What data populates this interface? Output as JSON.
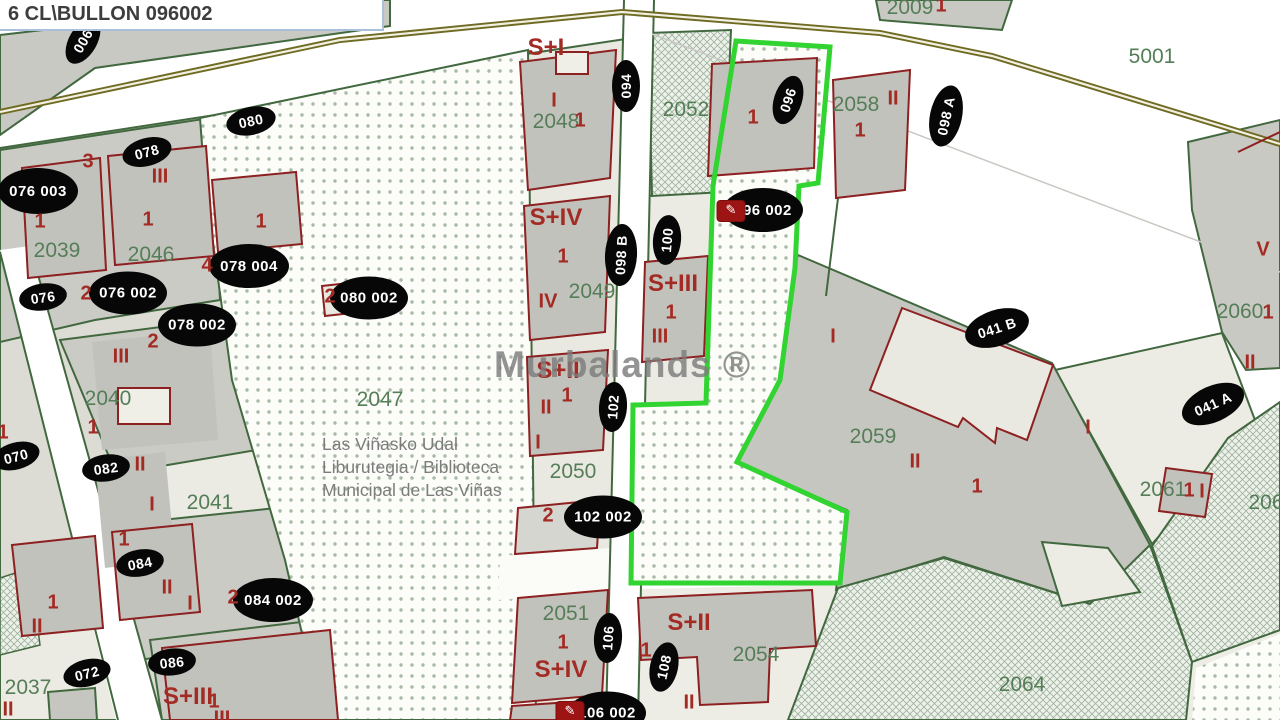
{
  "header": {
    "title": "6 CL\\BULLON 096002"
  },
  "watermark": "Murbalands ®",
  "library_poi": {
    "lines": [
      "Las Viñasko Udal",
      "Liburutegia / Biblioteca",
      "Municipal de Las Viñas"
    ]
  },
  "colors": {
    "selection_green": "#31d431",
    "boundary_green": "#42683f",
    "building_red": "#8d2020",
    "label_green": "#557e58",
    "label_red": "#a32b24",
    "road_olive": "#6f6b22",
    "oval_black": "#070707"
  },
  "icons": {
    "edit_glyph": "✎"
  },
  "map": {
    "ovals": [
      {
        "t": "006",
        "x": 83,
        "y": 41,
        "r": -60,
        "w": 50,
        "h": 28
      },
      {
        "t": "094",
        "x": 626,
        "y": 86,
        "r": -90,
        "w": 52,
        "h": 28
      },
      {
        "t": "096",
        "x": 788,
        "y": 100,
        "r": -72,
        "w": 50,
        "h": 28
      },
      {
        "t": "098 A",
        "x": 946,
        "y": 116,
        "r": -78,
        "w": 62,
        "h": 32
      },
      {
        "t": "076 003",
        "x": 38,
        "y": 191,
        "r": 0,
        "w": 80,
        "h": 46
      },
      {
        "t": "078",
        "x": 147,
        "y": 152,
        "r": -15,
        "w": 50,
        "h": 28
      },
      {
        "t": "080",
        "x": 251,
        "y": 121,
        "r": -12,
        "w": 50,
        "h": 28
      },
      {
        "t": "096 002",
        "x": 763,
        "y": 210,
        "r": 0,
        "w": 80,
        "h": 44
      },
      {
        "t": "098 B",
        "x": 621,
        "y": 255,
        "r": -87,
        "w": 62,
        "h": 32
      },
      {
        "t": "100",
        "x": 667,
        "y": 240,
        "r": -85,
        "w": 50,
        "h": 28
      },
      {
        "t": "078 004",
        "x": 249,
        "y": 266,
        "r": 0,
        "w": 80,
        "h": 44
      },
      {
        "t": "076",
        "x": 43,
        "y": 297,
        "r": -8,
        "w": 48,
        "h": 27
      },
      {
        "t": "076 002",
        "x": 128,
        "y": 293,
        "r": 0,
        "w": 78,
        "h": 43
      },
      {
        "t": "080 002",
        "x": 369,
        "y": 298,
        "r": 0,
        "w": 78,
        "h": 43
      },
      {
        "t": "078 002",
        "x": 197,
        "y": 325,
        "r": 0,
        "w": 78,
        "h": 43
      },
      {
        "t": "041 B",
        "x": 997,
        "y": 328,
        "r": -18,
        "w": 66,
        "h": 36
      },
      {
        "t": "041 A",
        "x": 1213,
        "y": 404,
        "r": -24,
        "w": 66,
        "h": 36
      },
      {
        "t": "102",
        "x": 613,
        "y": 407,
        "r": -86,
        "w": 50,
        "h": 28
      },
      {
        "t": "070",
        "x": 16,
        "y": 456,
        "r": -15,
        "w": 48,
        "h": 27
      },
      {
        "t": "082",
        "x": 106,
        "y": 468,
        "r": -8,
        "w": 48,
        "h": 27
      },
      {
        "t": "102 002",
        "x": 603,
        "y": 517,
        "r": 0,
        "w": 78,
        "h": 43
      },
      {
        "t": "084",
        "x": 140,
        "y": 563,
        "r": -10,
        "w": 48,
        "h": 27
      },
      {
        "t": "084 002",
        "x": 273,
        "y": 600,
        "r": 0,
        "w": 80,
        "h": 44
      },
      {
        "t": "106",
        "x": 608,
        "y": 638,
        "r": -86,
        "w": 50,
        "h": 28
      },
      {
        "t": "086",
        "x": 172,
        "y": 662,
        "r": -6,
        "w": 48,
        "h": 27
      },
      {
        "t": "108",
        "x": 664,
        "y": 667,
        "r": -78,
        "w": 50,
        "h": 28
      },
      {
        "t": "072",
        "x": 87,
        "y": 673,
        "r": -14,
        "w": 48,
        "h": 27
      },
      {
        "t": "106 002",
        "x": 607,
        "y": 713,
        "r": 0,
        "w": 78,
        "h": 43
      }
    ],
    "green_labels": [
      {
        "t": "2009",
        "x": 910,
        "y": 8
      },
      {
        "t": "5001",
        "x": 1152,
        "y": 57
      },
      {
        "t": "2052",
        "x": 686,
        "y": 110
      },
      {
        "t": "2058",
        "x": 856,
        "y": 105
      },
      {
        "t": "2048",
        "x": 556,
        "y": 122
      },
      {
        "t": "2039",
        "x": 57,
        "y": 251
      },
      {
        "t": "2046",
        "x": 151,
        "y": 255
      },
      {
        "t": "2049",
        "x": 592,
        "y": 292
      },
      {
        "t": "2060",
        "x": 1240,
        "y": 312
      },
      {
        "t": "2047",
        "x": 380,
        "y": 400
      },
      {
        "t": "2040",
        "x": 108,
        "y": 399
      },
      {
        "t": "2059",
        "x": 873,
        "y": 437
      },
      {
        "t": "2050",
        "x": 573,
        "y": 472
      },
      {
        "t": "2061",
        "x": 1163,
        "y": 490
      },
      {
        "t": "206",
        "x": 1266,
        "y": 503
      },
      {
        "t": "2041",
        "x": 210,
        "y": 503
      },
      {
        "t": "2051",
        "x": 566,
        "y": 614
      },
      {
        "t": "2054",
        "x": 756,
        "y": 655
      },
      {
        "t": "2064",
        "x": 1022,
        "y": 685
      },
      {
        "t": "2037",
        "x": 28,
        "y": 688
      }
    ],
    "red_labels": [
      {
        "t": "S+I",
        "x": 546,
        "y": 48,
        "s": 24
      },
      {
        "t": "1",
        "x": 941,
        "y": 6
      },
      {
        "t": "I",
        "x": 554,
        "y": 101
      },
      {
        "t": "II",
        "x": 893,
        "y": 99
      },
      {
        "t": "1",
        "x": 580,
        "y": 121
      },
      {
        "t": "1",
        "x": 753,
        "y": 118
      },
      {
        "t": "1",
        "x": 860,
        "y": 131
      },
      {
        "t": "3",
        "x": 88,
        "y": 162
      },
      {
        "t": "III",
        "x": 160,
        "y": 177
      },
      {
        "t": "S+IV",
        "x": 556,
        "y": 218,
        "s": 24
      },
      {
        "t": "1",
        "x": 40,
        "y": 222
      },
      {
        "t": "1",
        "x": 148,
        "y": 220
      },
      {
        "t": "1",
        "x": 261,
        "y": 222
      },
      {
        "t": "V",
        "x": 1263,
        "y": 250
      },
      {
        "t": "1",
        "x": 563,
        "y": 257
      },
      {
        "t": "4",
        "x": 207,
        "y": 266
      },
      {
        "t": "S+III",
        "x": 673,
        "y": 284,
        "s": 24
      },
      {
        "t": "2",
        "x": 86,
        "y": 294
      },
      {
        "t": "2",
        "x": 330,
        "y": 297
      },
      {
        "t": "IV",
        "x": 548,
        "y": 302
      },
      {
        "t": "1",
        "x": 671,
        "y": 313
      },
      {
        "t": "1",
        "x": 1268,
        "y": 313
      },
      {
        "t": "I",
        "x": 833,
        "y": 337
      },
      {
        "t": "III",
        "x": 660,
        "y": 337
      },
      {
        "t": "2",
        "x": 153,
        "y": 342
      },
      {
        "t": "III",
        "x": 121,
        "y": 357
      },
      {
        "t": "II",
        "x": 1250,
        "y": 363
      },
      {
        "t": "S+II",
        "x": 558,
        "y": 371,
        "s": 24
      },
      {
        "t": "1",
        "x": 567,
        "y": 396
      },
      {
        "t": "II",
        "x": 546,
        "y": 408
      },
      {
        "t": "1",
        "x": 93,
        "y": 428
      },
      {
        "t": "I",
        "x": 1088,
        "y": 428
      },
      {
        "t": "1",
        "x": 3,
        "y": 433
      },
      {
        "t": "I",
        "x": 538,
        "y": 443
      },
      {
        "t": "II",
        "x": 915,
        "y": 462
      },
      {
        "t": "II",
        "x": 140,
        "y": 465
      },
      {
        "t": "1",
        "x": 977,
        "y": 487
      },
      {
        "t": "1",
        "x": 1189,
        "y": 491
      },
      {
        "t": "I",
        "x": 1202,
        "y": 492
      },
      {
        "t": "I",
        "x": 152,
        "y": 505
      },
      {
        "t": "2",
        "x": 548,
        "y": 516
      },
      {
        "t": "1",
        "x": 124,
        "y": 540
      },
      {
        "t": "II",
        "x": 167,
        "y": 588
      },
      {
        "t": "2",
        "x": 233,
        "y": 598
      },
      {
        "t": "1",
        "x": 53,
        "y": 603
      },
      {
        "t": "I",
        "x": 190,
        "y": 604
      },
      {
        "t": "S+II",
        "x": 689,
        "y": 623,
        "s": 24
      },
      {
        "t": "II",
        "x": 37,
        "y": 627
      },
      {
        "t": "1",
        "x": 563,
        "y": 643
      },
      {
        "t": "1",
        "x": 646,
        "y": 651
      },
      {
        "t": "S+IV",
        "x": 561,
        "y": 670,
        "s": 24
      },
      {
        "t": "S+III",
        "x": 188,
        "y": 697,
        "s": 24
      },
      {
        "t": "1",
        "x": 214,
        "y": 702
      },
      {
        "t": "II",
        "x": 689,
        "y": 703
      },
      {
        "t": "II",
        "x": 8,
        "y": 710
      },
      {
        "t": "2",
        "x": 569,
        "y": 712
      },
      {
        "t": "III",
        "x": 222,
        "y": 719
      }
    ],
    "edit_icons": [
      {
        "x": 731,
        "y": 211
      },
      {
        "x": 570,
        "y": 712
      }
    ]
  }
}
